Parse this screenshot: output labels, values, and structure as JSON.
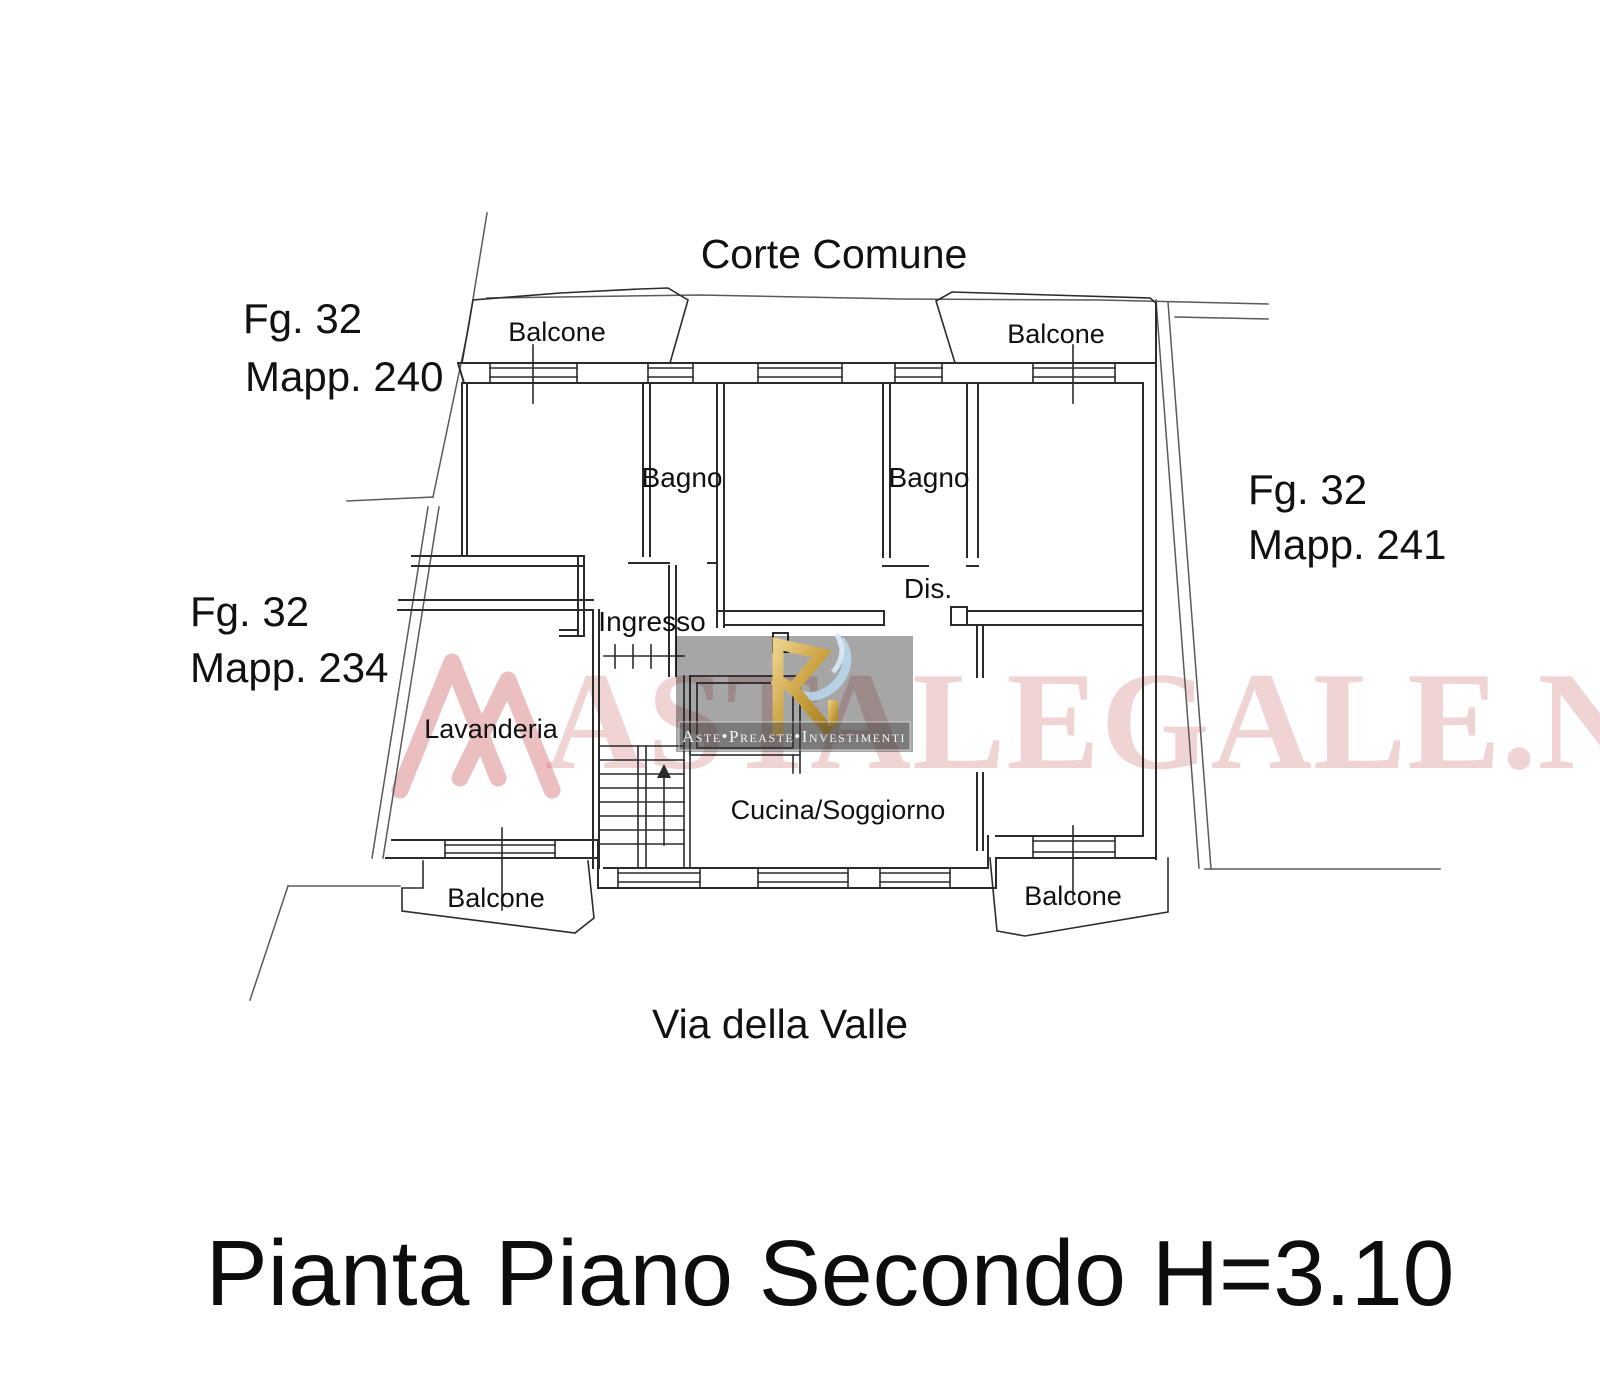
{
  "plan": {
    "title": "Pianta Piano Secondo H=3.10",
    "courtyard_label": "Corte Comune",
    "street_label": "Via della Valle",
    "parcels": {
      "top_left": {
        "line1": "Fg. 32",
        "line2": "Mapp. 240"
      },
      "mid_left": {
        "line1": "Fg. 32",
        "line2": "Mapp. 234"
      },
      "right": {
        "line1": "Fg. 32",
        "line2": "Mapp. 241"
      }
    },
    "rooms": {
      "balcone_tl": "Balcone",
      "balcone_tr": "Balcone",
      "balcone_bl": "Balcone",
      "balcone_br": "Balcone",
      "bagno_left": "Bagno",
      "bagno_right": "Bagno",
      "dis": "Dis.",
      "ingresso": "Ingresso",
      "lavanderia": "Lavanderia",
      "cucina": "Cucina/Soggiorno"
    }
  },
  "watermark": {
    "site_text": "ASTALEGALE.NET",
    "caption": "Aste•Preaste•Investimenti",
    "monogram": "R",
    "colors": {
      "pink": "#c65454",
      "box_gray": "#a6a6a6",
      "gold": "#c9a13b",
      "blue": "#b9d6ec"
    }
  }
}
